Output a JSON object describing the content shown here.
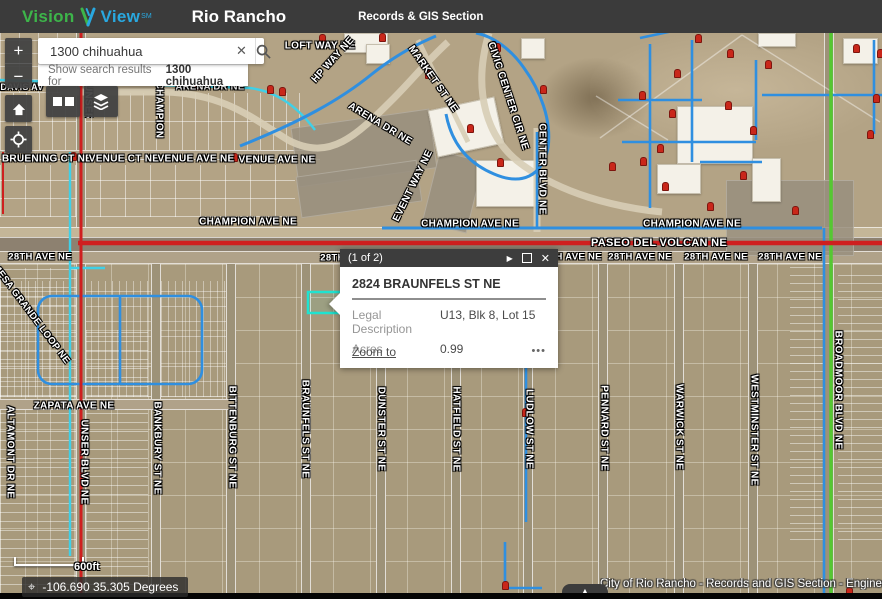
{
  "header": {
    "logo": {
      "vision": "Vision",
      "view": "View",
      "sm": "SM"
    },
    "app_title": "Rio Rancho",
    "section": "Records & GIS Section"
  },
  "search": {
    "value": "1300 chihuahua",
    "clear_glyph": "✕",
    "suggestion_prefix": "Show search results for",
    "suggestion_term": "1300 chihuahua"
  },
  "controls": {
    "zoom_in": "+",
    "zoom_out": "−"
  },
  "popup": {
    "pagination": "(1 of 2)",
    "next_glyph": "▶",
    "close_glyph": "✕",
    "title": "2824 BRAUNFELS ST NE",
    "fields": [
      {
        "label": "Legal Description",
        "value": "U13, Blk 8, Lot 15"
      },
      {
        "label": "Acres",
        "value": "0.99"
      }
    ],
    "zoom_to": "Zoom to",
    "more": "•••"
  },
  "footer": {
    "scale_label": "600ft",
    "crosshair_glyph": "⌖",
    "coordinates": "-106.690 35.305 Degrees",
    "attribution": "City of Rio Rancho - Records and GIS Section - Enginee",
    "expander_glyph": "▲"
  },
  "map": {
    "colors": {
      "road_red": "#cf1f1f",
      "utility_green": "#55c832",
      "utility_blue": "#2f8fe0",
      "utility_cyan": "#3fd0e8",
      "highlight_teal": "#1fe3d0",
      "hydrant_red": "#c9271a"
    },
    "street_labels": [
      {
        "text": "DAVIS AV",
        "x": 22,
        "y": 87,
        "size": 9
      },
      {
        "text": "LOFT WAY NE",
        "x": 320,
        "y": 46
      },
      {
        "text": "ARENA DR NE",
        "x": 210,
        "y": 87,
        "size": 9.5
      },
      {
        "text": "BRUENING CT NE",
        "x": 47,
        "y": 159
      },
      {
        "text": "VENUE CT NE",
        "x": 124,
        "y": 159
      },
      {
        "text": "VENUE AVE NE",
        "x": 196,
        "y": 159
      },
      {
        "text": "VENUE AVE NE",
        "x": 277,
        "y": 160
      },
      {
        "text": "CHAMPION AVE NE",
        "x": 248,
        "y": 222
      },
      {
        "text": "CHAMPION AVE NE",
        "x": 470,
        "y": 224
      },
      {
        "text": "CHAMPION AVE NE",
        "x": 692,
        "y": 224
      },
      {
        "text": "PASEO DEL VOLCAN NE",
        "x": 659,
        "y": 243,
        "size": 11
      },
      {
        "text": "28TH AVE NE",
        "x": 40,
        "y": 257,
        "size": 9.5
      },
      {
        "text": "28TH AVE NE",
        "x": 352,
        "y": 258,
        "size": 9.5
      },
      {
        "text": "28TH AVE NE",
        "x": 570,
        "y": 257,
        "size": 9.5
      },
      {
        "text": "28TH AVE NE",
        "x": 640,
        "y": 257,
        "size": 9.5
      },
      {
        "text": "28TH AVE NE",
        "x": 716,
        "y": 257,
        "size": 9.5
      },
      {
        "text": "28TH AVE NE",
        "x": 790,
        "y": 257,
        "size": 9.5
      },
      {
        "text": "ZAPATA AVE NE",
        "x": 74,
        "y": 406
      },
      {
        "text": "CHAMPION",
        "x": 159,
        "y": 110,
        "v": true
      },
      {
        "text": "UNSER BLVD NE",
        "x": 88,
        "y": 84,
        "v": true,
        "clip": 34
      },
      {
        "text": "CENTER BLVD NE",
        "x": 542,
        "y": 169,
        "v": true
      },
      {
        "text": "ALTAMONT DR NE",
        "x": 10,
        "y": 452,
        "v": true
      },
      {
        "text": "UNSER BLVD NE",
        "x": 84,
        "y": 462,
        "v": true
      },
      {
        "text": "BANKBURY ST NE",
        "x": 157,
        "y": 448,
        "v": true
      },
      {
        "text": "BITTENBURG ST NE",
        "x": 232,
        "y": 437,
        "v": true
      },
      {
        "text": "BRAUNFELS ST NE",
        "x": 305,
        "y": 429,
        "v": true
      },
      {
        "text": "DUNSTER ST NE",
        "x": 381,
        "y": 429,
        "v": true
      },
      {
        "text": "HATFIELD ST NE",
        "x": 456,
        "y": 429,
        "v": true
      },
      {
        "text": "LUDLOW ST NE",
        "x": 529,
        "y": 429,
        "v": true
      },
      {
        "text": "PENNARD ST NE",
        "x": 604,
        "y": 428,
        "v": true
      },
      {
        "text": "WARWICK ST NE",
        "x": 679,
        "y": 427,
        "v": true
      },
      {
        "text": "WESTMINSTER ST NE",
        "x": 754,
        "y": 430,
        "v": true
      },
      {
        "text": "BROADMOOR BLVD NE",
        "x": 838,
        "y": 390,
        "v": true
      },
      {
        "text": "HP WAY NE",
        "x": 333,
        "y": 60,
        "rot": -48
      },
      {
        "text": "MARKET ST NE",
        "x": 433,
        "y": 79,
        "rot": 55
      },
      {
        "text": "CIVIC CENTER CIR NE",
        "x": 508,
        "y": 96,
        "rot": 72
      },
      {
        "text": "ARENA DR NE",
        "x": 380,
        "y": 124,
        "rot": 31
      },
      {
        "text": "EVENT WAY NE",
        "x": 413,
        "y": 186,
        "rot": -64
      },
      {
        "text": "MESA GRANDE LOOP NE",
        "x": 31,
        "y": 314,
        "rot": 53,
        "size": 9.5
      }
    ],
    "hydrants": [
      [
        213,
        42
      ],
      [
        322,
        38
      ],
      [
        382,
        37
      ],
      [
        428,
        74
      ],
      [
        497,
        47
      ],
      [
        543,
        89
      ],
      [
        470,
        128
      ],
      [
        500,
        162
      ],
      [
        196,
        85
      ],
      [
        270,
        89
      ],
      [
        282,
        91
      ],
      [
        234,
        157
      ],
      [
        73,
        156
      ],
      [
        698,
        38
      ],
      [
        730,
        53
      ],
      [
        768,
        64
      ],
      [
        677,
        73
      ],
      [
        642,
        95
      ],
      [
        728,
        105
      ],
      [
        672,
        113
      ],
      [
        753,
        130
      ],
      [
        660,
        148
      ],
      [
        612,
        166
      ],
      [
        643,
        161
      ],
      [
        665,
        186
      ],
      [
        710,
        206
      ],
      [
        743,
        175
      ],
      [
        856,
        48
      ],
      [
        876,
        98
      ],
      [
        870,
        134
      ],
      [
        795,
        210
      ],
      [
        880,
        53
      ],
      [
        525,
        412
      ],
      [
        505,
        585
      ],
      [
        849,
        591
      ]
    ]
  }
}
